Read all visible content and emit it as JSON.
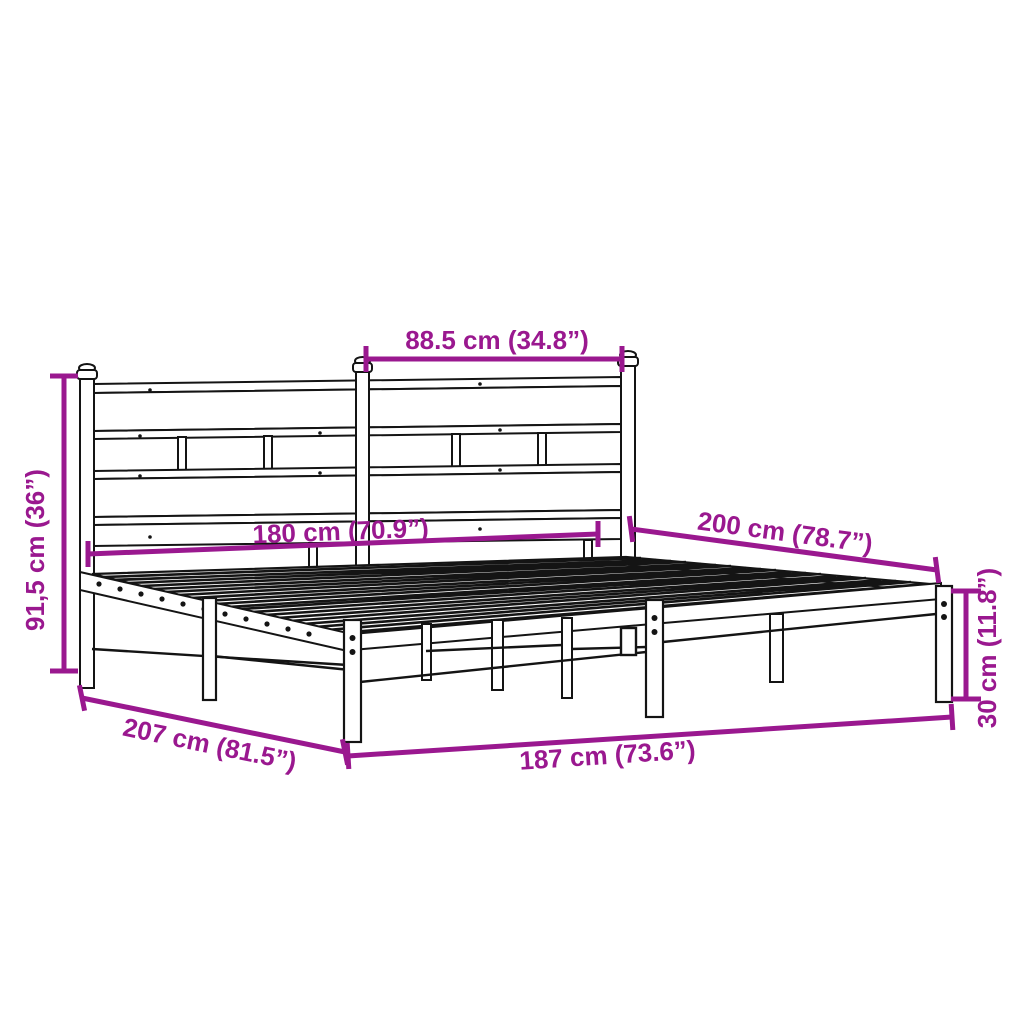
{
  "diagram": {
    "title": "Metal bed frame with headboard — dimension diagram",
    "background_color": "#ffffff",
    "dimension_color": "#9A188F",
    "drawing_color": "#141414",
    "dimensions": [
      {
        "name": "headboard-section-width",
        "cm": "88.5",
        "inches": "34.8",
        "label": "88.5 cm (34.8”)"
      },
      {
        "name": "headboard-height",
        "cm": "91,5",
        "inches": "36",
        "label": "91,5 cm (36”)"
      },
      {
        "name": "inner-width",
        "cm": "180",
        "inches": "70.9",
        "label": "180 cm (70.9”)"
      },
      {
        "name": "inner-length",
        "cm": "200",
        "inches": "78.7",
        "label": "200 cm (78.7”)"
      },
      {
        "name": "base-height",
        "cm": "30",
        "inches": "11.8",
        "label": "30 cm (11.8”)"
      },
      {
        "name": "total-length",
        "cm": "207",
        "inches": "81.5",
        "label": "207 cm (81.5”)"
      },
      {
        "name": "total-width",
        "cm": "187",
        "inches": "73.6",
        "label": "187 cm (73.6”)"
      }
    ]
  }
}
